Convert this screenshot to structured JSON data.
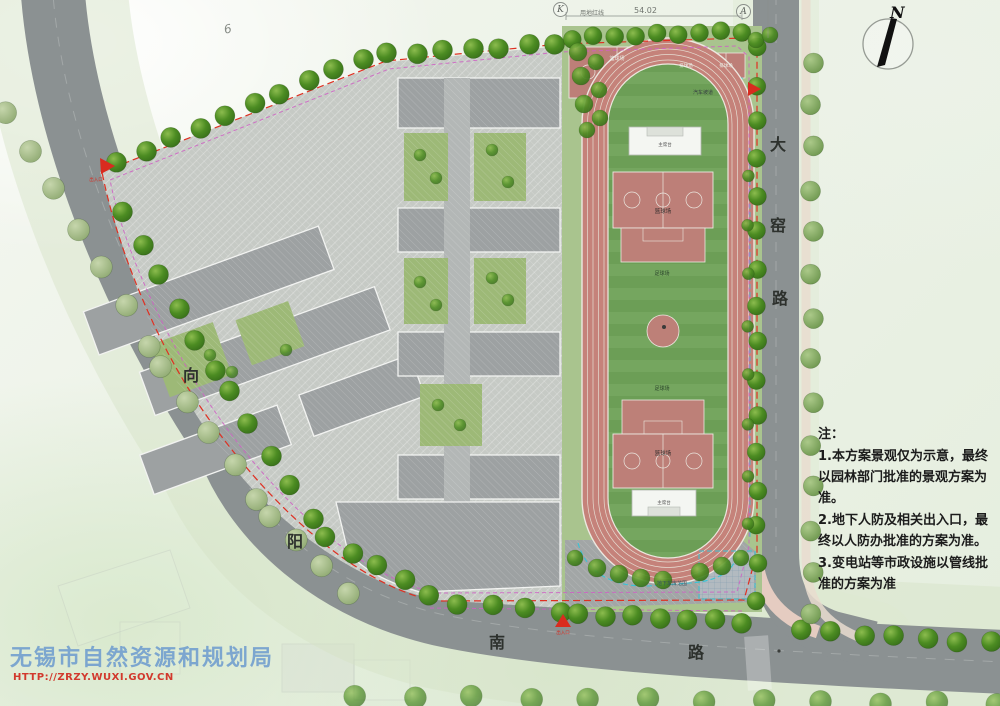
{
  "north": {
    "label": "N"
  },
  "watermark": {
    "agency": "无锡市自然资源和规划局",
    "url": "HTTP://ZRZY.WUXI.GOV.CN"
  },
  "notes": {
    "heading": "注：",
    "note1": "1.本方案景观仅为示意，最终以园林部门批准的景观方案为准。",
    "note2": "2.地下人防及相关出入口，最终以人防办批准的方案为准。",
    "note3": "3.变电站等市政设施以管线批准的方案为准"
  },
  "roads": {
    "xiang": "向",
    "yang": "阳",
    "nan": "南",
    "lu_south": "路",
    "da": "大",
    "yao": "窑",
    "lu_east": "路"
  },
  "annotations": {
    "dim_top": "54.02",
    "red_line": "用地红线",
    "plot_no": "6",
    "ref_k": "K",
    "ref_a": "A",
    "entrance": "出入口"
  },
  "facilities": {
    "basketball_infield_top": "篮球场",
    "basketball_infield_bottom": "篮球场",
    "basketball_outer": "篮球场",
    "volleyball_1": "排球场",
    "volleyball_2": "排球场",
    "car_ramp": "汽车坡道",
    "soccer_1": "足球场",
    "soccer_2": "足球场",
    "stand_top": "主席台",
    "stand_bottom": "主席台",
    "garage": "地下车库范围"
  },
  "colors": {
    "boundary_red": "#df3022",
    "boundary_magenta": "#cf5fc4",
    "garage_cyan": "#38c4d6",
    "track": "#c5827a",
    "field_green": "#74a55e",
    "court_pink": "#bd7f78",
    "road_gray": "#8b9192",
    "tree_green": "#4c8c22",
    "watermark_blue": "#6e9cce",
    "watermark_red": "#d2392d"
  }
}
